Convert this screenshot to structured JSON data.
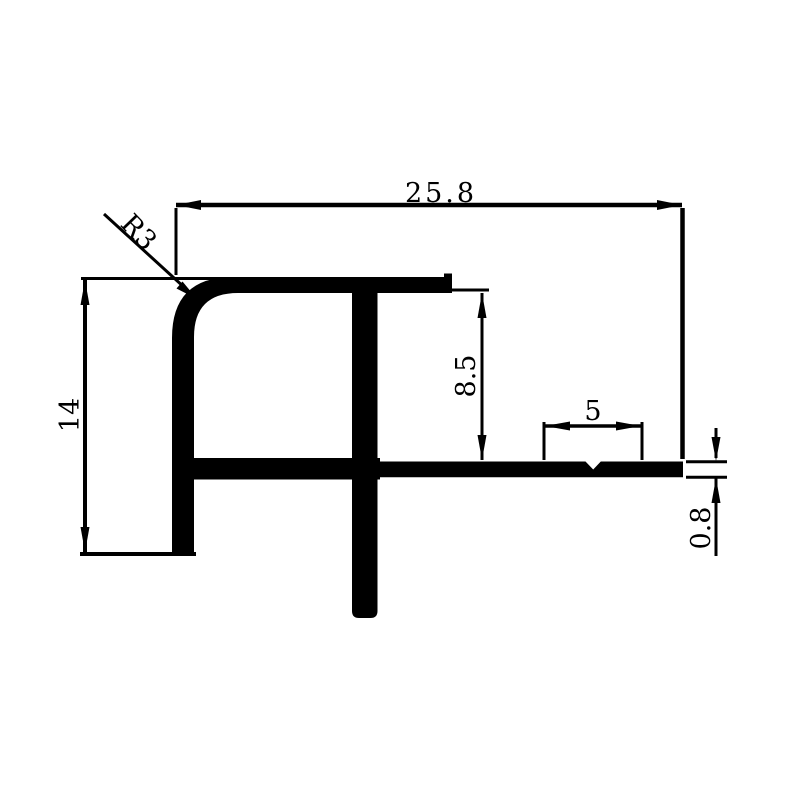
{
  "colors": {
    "ink": "#000000",
    "background": "#ffffff"
  },
  "dimensions": {
    "overall_width": "25.8",
    "corner_radius": "R3",
    "overall_height": "14",
    "channel_depth": "8.5",
    "punch_width": "5",
    "wing_thickness": "0.8"
  }
}
